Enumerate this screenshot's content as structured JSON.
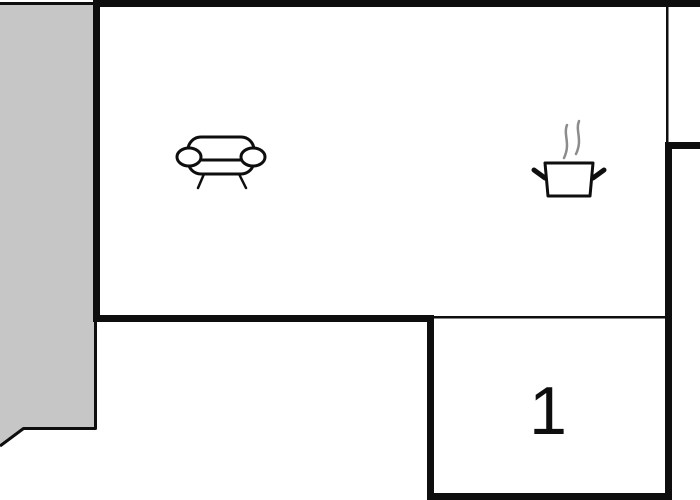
{
  "floorplan": {
    "type": "floor-plan",
    "room1_label": "1",
    "colors": {
      "bg": "#ffffff",
      "wall": "#0e0e0e",
      "terrace": "#c6c6c6",
      "steam": "#8c8c8c"
    },
    "icons": [
      {
        "name": "sofa-icon",
        "depicts": "sofa / seating area"
      },
      {
        "name": "stove-icon",
        "depicts": "cooking pot with steam / kitchen"
      }
    ],
    "areas": [
      {
        "name": "terrace",
        "label": ""
      },
      {
        "name": "living-kitchen-room",
        "label": ""
      },
      {
        "name": "room-1",
        "label": "1"
      }
    ]
  }
}
